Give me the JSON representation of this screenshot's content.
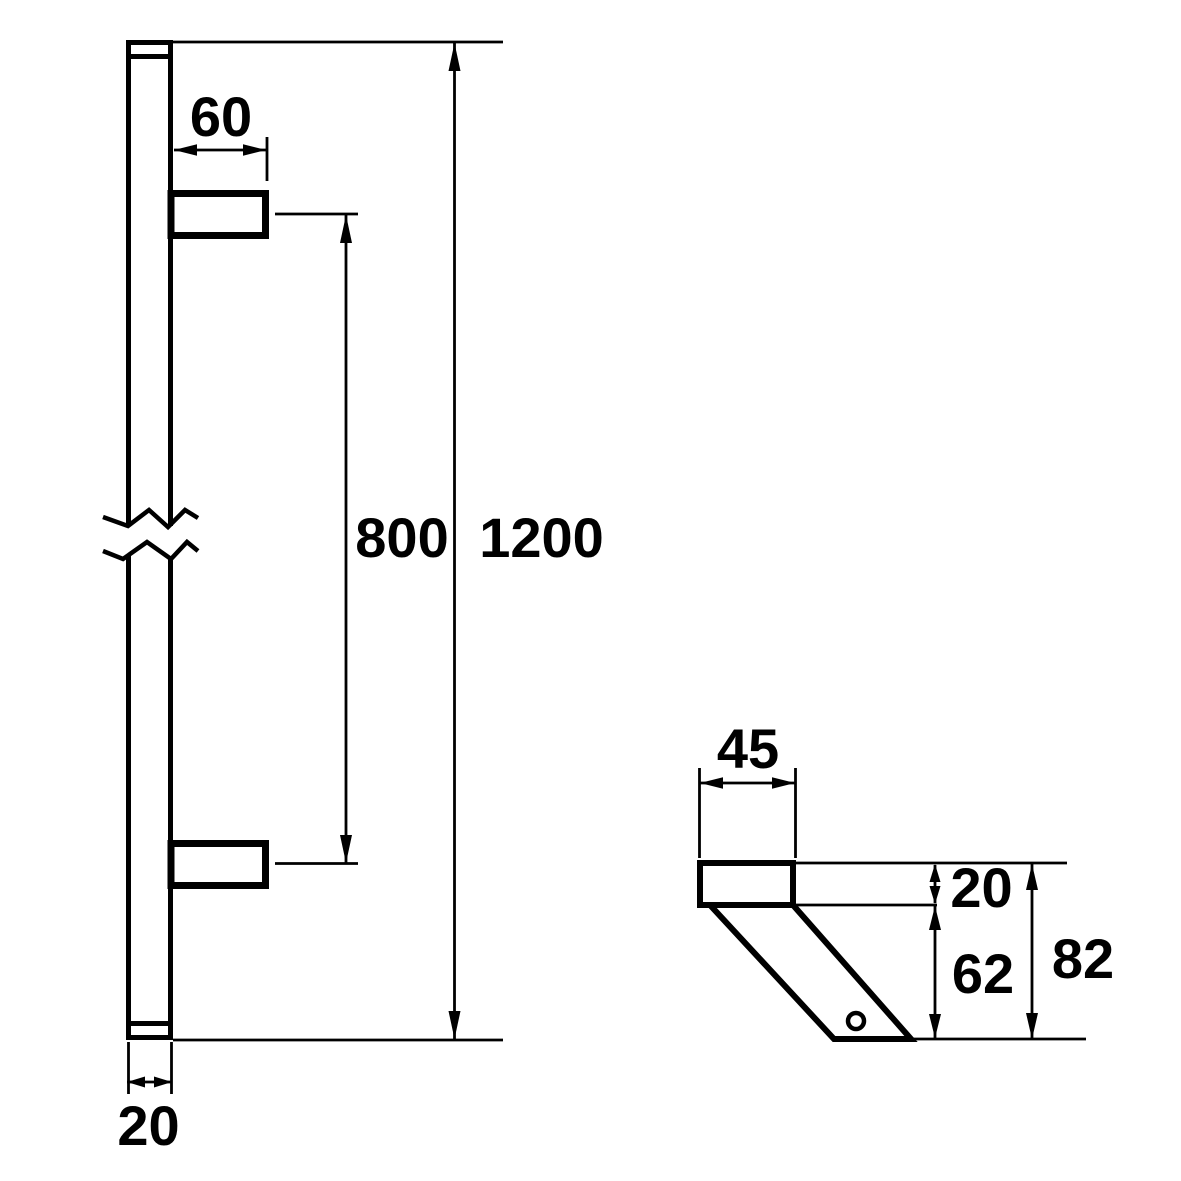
{
  "drawing": {
    "colors": {
      "line": "#000000",
      "background": "#ffffff"
    },
    "front_view": {
      "bracket_length": "60",
      "mounting_centers": "800",
      "overall_length": "1200",
      "bar_width": "20"
    },
    "side_view": {
      "bracket_depth": "45",
      "plate_thickness": "20",
      "arm_height": "62",
      "overall_projection": "82"
    }
  }
}
